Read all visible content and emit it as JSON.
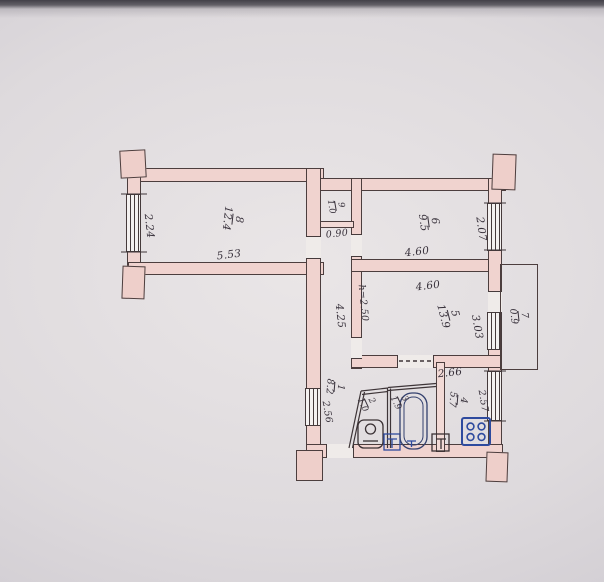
{
  "document": {
    "kind": "apartment floor plan drawing",
    "colors": {
      "wall_fill": "#f0d3cf",
      "ink": "#37303a",
      "fixture_blue": "#2e4a9e",
      "paper": "#dedadd"
    }
  },
  "rooms": {
    "room8": {
      "num": "8",
      "area": "12.4"
    },
    "closet": {
      "num": "9",
      "area": "1.0"
    },
    "room6": {
      "num": "6",
      "area": "9.5"
    },
    "room5": {
      "num": "5",
      "area": "13.9",
      "ceiling": "h=2.50"
    },
    "balcony": {
      "num": "7",
      "area": "0.9"
    },
    "hall": {
      "num": "1",
      "area": "8.2"
    },
    "wc": {
      "num": "2",
      "area": "1.0"
    },
    "bath": {
      "num": "3",
      "area": "1.9"
    },
    "kitchen": {
      "num": "4",
      "area": "5.7"
    }
  },
  "dims": {
    "room8_width": "5.53",
    "room8_depth": "2.24",
    "closet_width": "0.90",
    "room6_width": "4.60",
    "room6_depth": "2.07",
    "room5_width": "4.60",
    "room5_depth": "3.03",
    "corridor_length": "4.25",
    "kitchen_top": "2.66",
    "kitchen_side": "2.57",
    "hall_side": "2.56"
  }
}
